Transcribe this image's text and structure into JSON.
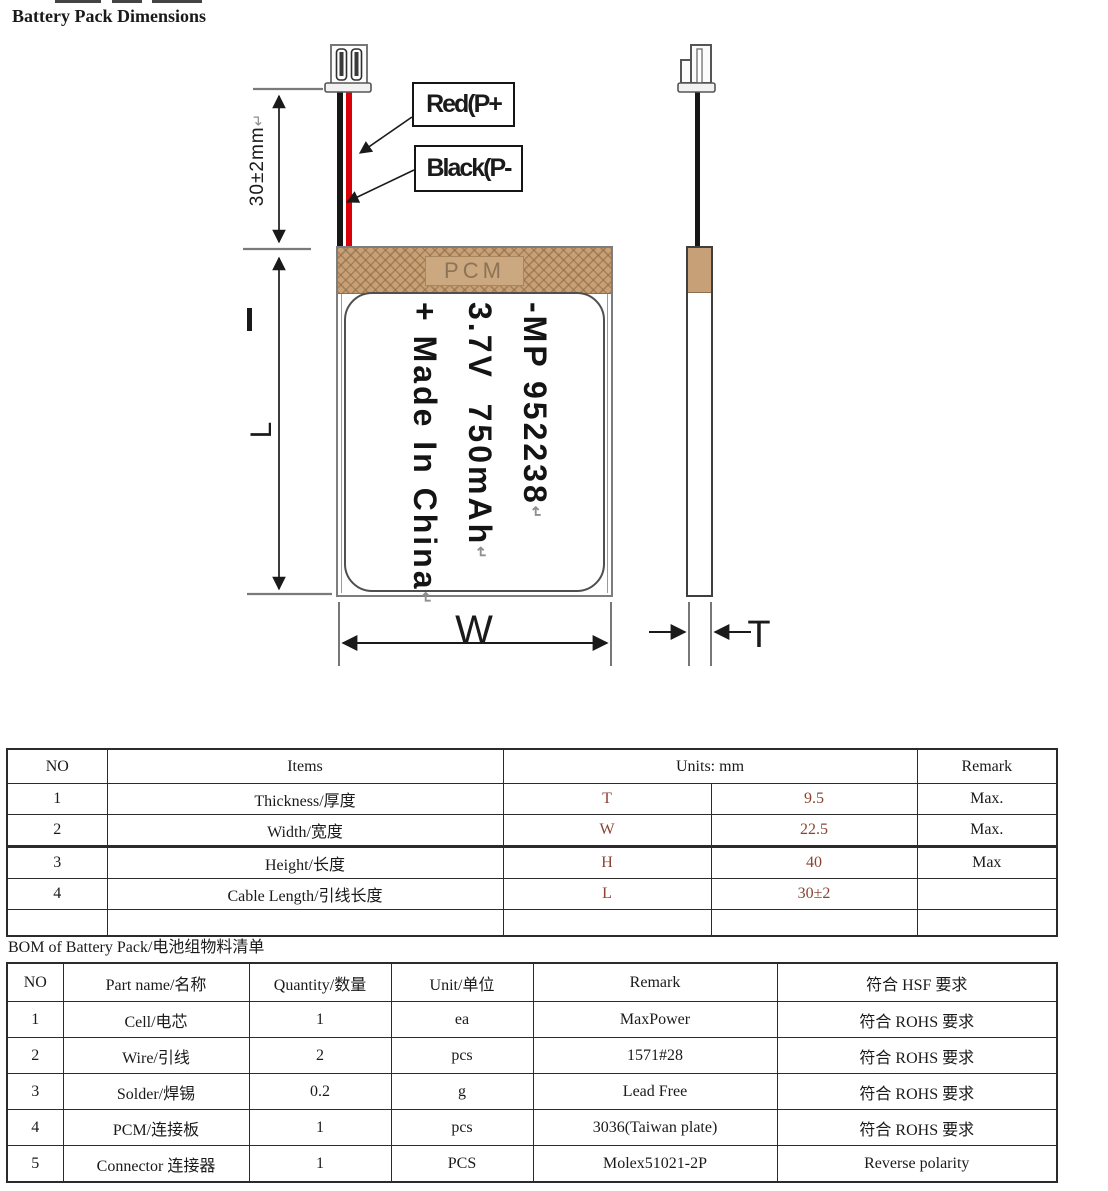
{
  "page": {
    "title": "Battery Pack Dimensions"
  },
  "diagram": {
    "wire_labels": {
      "red": "Red(P+",
      "black": "Black(P-"
    },
    "pcm_label": "PCM",
    "battery_label_lines": [
      {
        "text": "-MP 952238",
        "ret": "↵"
      },
      {
        "text": "3.7V  750mAh",
        "ret": "↵"
      },
      {
        "text": "+ Made In China",
        "ret": "↵"
      }
    ],
    "dimensions": {
      "cable": {
        "text": "30±2mm",
        "ret": "↵"
      },
      "length": "L",
      "width": "W",
      "thickness": "T"
    },
    "colors": {
      "pcm_tan": "#C8A078",
      "pcm_hatch": "#8A683C",
      "wire_red": "#DB0008",
      "wire_black": "#161616"
    }
  },
  "dim_table": {
    "headers": {
      "no": "NO",
      "items": "Items",
      "units": "Units: mm",
      "remark": "Remark"
    },
    "accent_color": "#8B4434",
    "rows": [
      {
        "no": "1",
        "item": "Thickness/厚度",
        "letter": "T",
        "value": "9.5",
        "remark": "Max."
      },
      {
        "no": "2",
        "item": "Width/宽度",
        "letter": "W",
        "value": "22.5",
        "remark": "Max."
      },
      {
        "no": "3",
        "item": "Height/长度",
        "letter": "H",
        "value": "40",
        "remark": "Max"
      },
      {
        "no": "4",
        "item": "Cable Length/引线长度",
        "letter": "L",
        "value": "30±2",
        "remark": ""
      },
      {
        "no": "",
        "item": "",
        "letter": "",
        "value": "",
        "remark": ""
      }
    ]
  },
  "bom_table": {
    "caption": "BOM of Battery Pack/电池组物料清单",
    "headers": [
      "NO",
      "Part name/名称",
      "Quantity/数量",
      "Unit/单位",
      "Remark",
      "符合 HSF 要求"
    ],
    "rows": [
      [
        "1",
        "Cell/电芯",
        "1",
        "ea",
        "MaxPower",
        "符合 ROHS 要求"
      ],
      [
        "2",
        "Wire/引线",
        "2",
        "pcs",
        "1571#28",
        "符合 ROHS 要求"
      ],
      [
        "3",
        "Solder/焊锡",
        "0.2",
        "g",
        "Lead Free",
        "符合 ROHS 要求"
      ],
      [
        "4",
        "PCM/连接板",
        "1",
        "pcs",
        "3036(Taiwan plate)",
        "符合 ROHS 要求"
      ],
      [
        "5",
        "Connector 连接器",
        "1",
        "PCS",
        "Molex51021-2P",
        "Reverse polarity"
      ]
    ]
  }
}
